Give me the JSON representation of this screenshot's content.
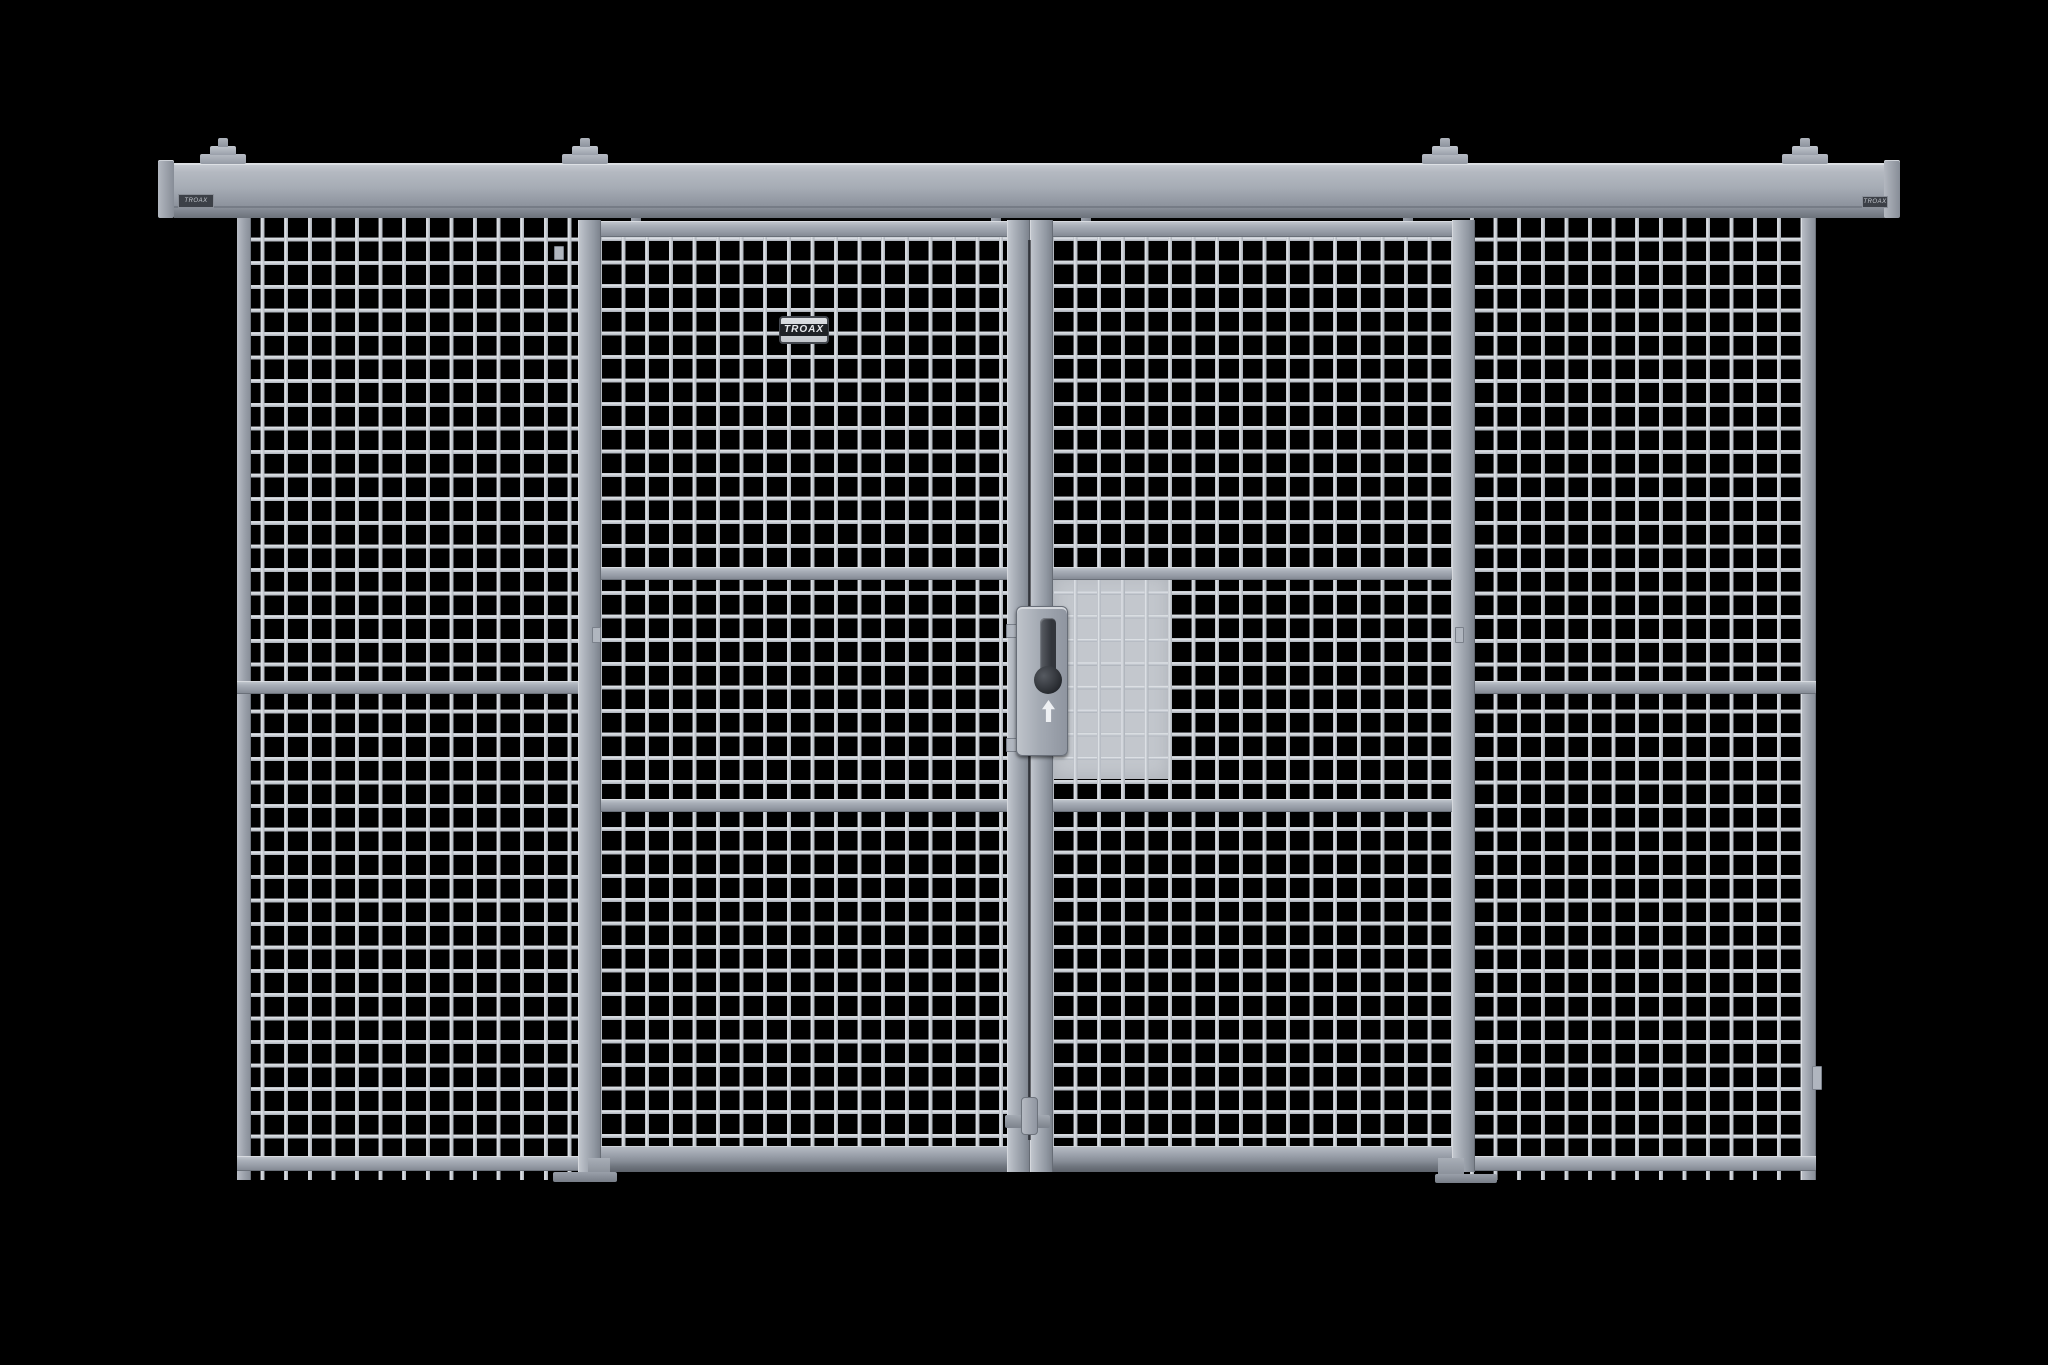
{
  "scene": {
    "subject": "Industrial wire mesh partition with double sliding doors on overhead track",
    "background_color": "#000000"
  },
  "branding": {
    "door_label": "TROAX",
    "track_label_left": "TROAX",
    "track_label_right": "TROAX"
  },
  "colors": {
    "background": "#000000",
    "mesh_wire": "#ccd1d7",
    "frame_gray": "#9aa0aa",
    "track_gray": "#a6acb5",
    "lock_body": "#a4aab3",
    "lock_handle": "#32353b",
    "backing_plate": "#c3c7cd",
    "label_plate": "#d0d4d9",
    "label_text": "#e8eaee"
  },
  "components": {
    "top_track_count": 1,
    "mounting_bracket_count": 4,
    "fixed_mesh_panel_count": 2,
    "sliding_door_count": 2,
    "hanger_bolt_count": 4,
    "floor_guide_count": 2,
    "lock_description": "lock case with vertical handle and keyhole over solid backing plate",
    "bottom_latch_count": 1
  }
}
